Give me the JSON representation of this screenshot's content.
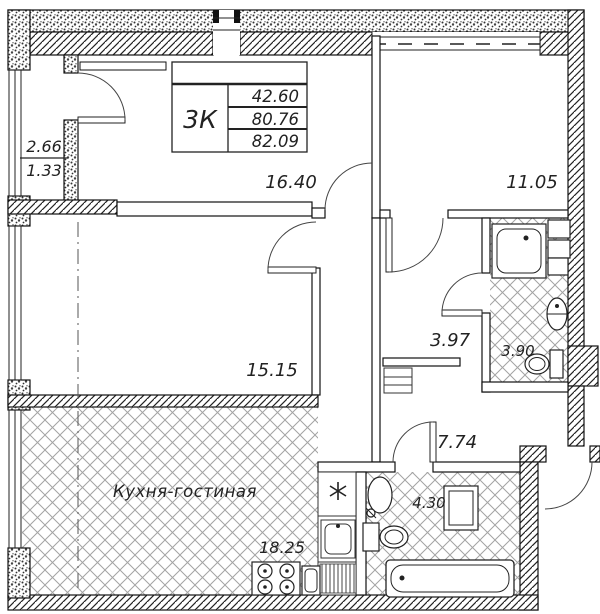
{
  "title_block": {
    "flat_type": "3К",
    "living_area": "42.60",
    "floor_area": "80.76",
    "total_area": "82.09"
  },
  "labels": {
    "balcony_area": "2.66",
    "balcony_reduced": "1.33",
    "room_top_left": "16.40",
    "room_top_right": "11.05",
    "room_middle": "15.15",
    "hall_small": "3.97",
    "bathroom_top": "3.90",
    "hallway": "7.74",
    "bathroom_bottom": "4.30",
    "kitchen_area": "18.25",
    "kitchen_name": "Кухня-гостиная"
  },
  "colors": {
    "line": "#111111",
    "tile_line": "#a3a3a3",
    "background": "#ffffff"
  }
}
